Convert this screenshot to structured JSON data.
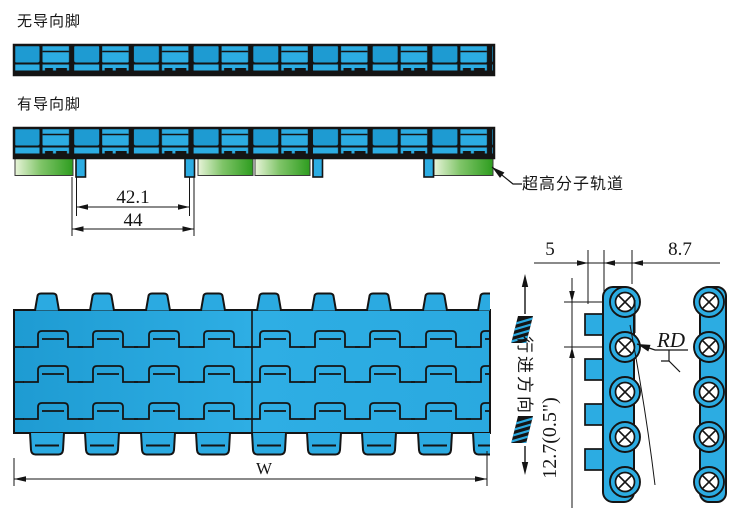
{
  "drawing": {
    "labels": {
      "no_guide_feet": "无导向脚",
      "with_guide_feet": "有导向脚",
      "track_callout": "超高分子轨道",
      "travel_direction": "行进方向"
    },
    "dimensions": {
      "guide_foot_inner_spacing": "42.1",
      "guide_foot_outer_spacing": "44",
      "belt_width": "W",
      "guide_tab_width": "5",
      "link_thickness": "8.7",
      "back_flex_radius": "RD",
      "pitch": "12.7(0.5\")"
    },
    "colors": {
      "belt_blue": "#29A7DE",
      "belt_blue_dark": "#1E9BD2",
      "belt_blue_light": "#3CB6EA",
      "track_green": "#2E9D1F",
      "track_green_light": "#E8F4D9",
      "outline": "#141414"
    }
  }
}
